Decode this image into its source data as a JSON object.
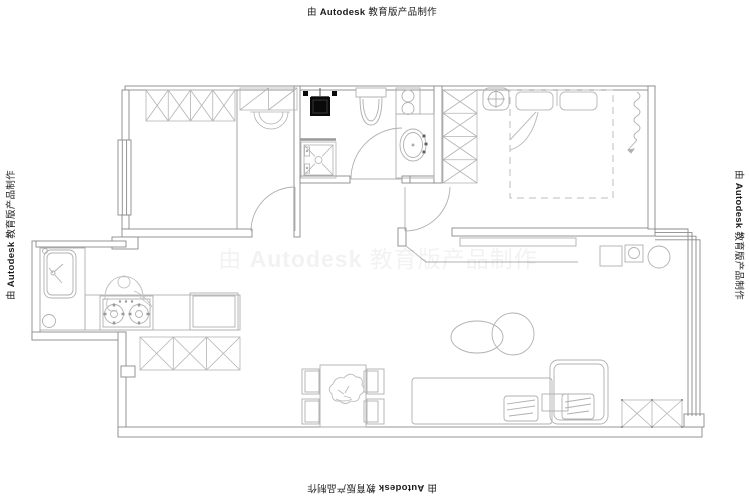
{
  "watermark": {
    "prefix": "由 ",
    "brand": "Autodesk",
    "suffix": " 教育版产品制作",
    "full": "由 Autodesk 教育版产品制作"
  },
  "colors": {
    "background": "#ffffff",
    "wall_line": "#8a8a8a",
    "furniture_line": "#aeaeae",
    "hatch_line": "#b4b4b4",
    "black_fixture": "#0a0a0a",
    "watermark_text": "#1c1c1c",
    "watermark_faint": "rgba(0,0,0,0.05)"
  },
  "floor_plan": {
    "type": "apartment-floor-plan",
    "rooms": [
      {
        "name": "bedroom-1",
        "features": [
          "wardrobe-hatched",
          "overhead-shelf",
          "dressing-table",
          "window-left",
          "door"
        ]
      },
      {
        "name": "bathroom",
        "features": [
          "water-heater",
          "shower-tray",
          "toilet",
          "laundry-unit",
          "vanity-wash-basin",
          "door"
        ]
      },
      {
        "name": "bedroom-2",
        "features": [
          "wardrobe-column",
          "bedside-stool",
          "double-bed",
          "curtain-coil",
          "door"
        ]
      },
      {
        "name": "kitchen",
        "features": [
          "sink",
          "gas-stove",
          "cook-figure",
          "fridge",
          "floor-drain",
          "base-cabinet"
        ]
      },
      {
        "name": "dining-area",
        "features": [
          "dining-table",
          "four-chairs",
          "plant-centerpiece",
          "storage-hatched-cabinet"
        ]
      },
      {
        "name": "living-room",
        "features": [
          "corner-sofa",
          "sofa-cushions",
          "oval-coffee-table",
          "round-coffee-table",
          "tv-console",
          "utility-boxes",
          "window-right",
          "corner-cabinet"
        ]
      }
    ]
  }
}
